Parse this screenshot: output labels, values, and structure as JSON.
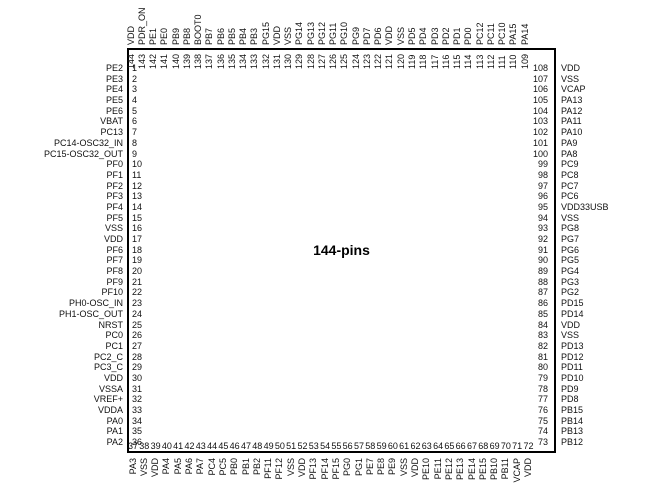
{
  "chip": {
    "title": "144-pins"
  },
  "colors": {
    "ink": "#111111",
    "border": "#000000",
    "background": "#ffffff"
  },
  "pins": {
    "left": [
      {
        "n": "1",
        "l": "PE2"
      },
      {
        "n": "2",
        "l": "PE3"
      },
      {
        "n": "3",
        "l": "PE4"
      },
      {
        "n": "4",
        "l": "PE5"
      },
      {
        "n": "5",
        "l": "PE6"
      },
      {
        "n": "6",
        "l": "VBAT"
      },
      {
        "n": "7",
        "l": "PC13"
      },
      {
        "n": "8",
        "l": "PC14-OSC32_IN"
      },
      {
        "n": "9",
        "l": "PC15-OSC32_OUT"
      },
      {
        "n": "10",
        "l": "PF0"
      },
      {
        "n": "11",
        "l": "PF1"
      },
      {
        "n": "12",
        "l": "PF2"
      },
      {
        "n": "13",
        "l": "PF3"
      },
      {
        "n": "14",
        "l": "PF4"
      },
      {
        "n": "15",
        "l": "PF5"
      },
      {
        "n": "16",
        "l": "VSS"
      },
      {
        "n": "17",
        "l": "VDD"
      },
      {
        "n": "18",
        "l": "PF6"
      },
      {
        "n": "19",
        "l": "PF7"
      },
      {
        "n": "20",
        "l": "PF8"
      },
      {
        "n": "21",
        "l": "PF9"
      },
      {
        "n": "22",
        "l": "PF10"
      },
      {
        "n": "23",
        "l": "PH0-OSC_IN"
      },
      {
        "n": "24",
        "l": "PH1-OSC_OUT"
      },
      {
        "n": "25",
        "l": "NRST"
      },
      {
        "n": "26",
        "l": "PC0"
      },
      {
        "n": "27",
        "l": "PC1"
      },
      {
        "n": "28",
        "l": "PC2_C"
      },
      {
        "n": "29",
        "l": "PC3_C"
      },
      {
        "n": "30",
        "l": "VDD"
      },
      {
        "n": "31",
        "l": "VSSA"
      },
      {
        "n": "32",
        "l": "VREF+"
      },
      {
        "n": "33",
        "l": "VDDA"
      },
      {
        "n": "34",
        "l": "PA0"
      },
      {
        "n": "35",
        "l": "PA1"
      },
      {
        "n": "36",
        "l": "PA2"
      }
    ],
    "bottom": [
      {
        "n": "37",
        "l": "PA3"
      },
      {
        "n": "38",
        "l": "VSS"
      },
      {
        "n": "39",
        "l": "VDD"
      },
      {
        "n": "40",
        "l": "PA4"
      },
      {
        "n": "41",
        "l": "PA5"
      },
      {
        "n": "42",
        "l": "PA6"
      },
      {
        "n": "43",
        "l": "PA7"
      },
      {
        "n": "44",
        "l": "PC4"
      },
      {
        "n": "45",
        "l": "PC5"
      },
      {
        "n": "46",
        "l": "PB0"
      },
      {
        "n": "47",
        "l": "PB1"
      },
      {
        "n": "48",
        "l": "PB2"
      },
      {
        "n": "49",
        "l": "PF11"
      },
      {
        "n": "50",
        "l": "PF12"
      },
      {
        "n": "51",
        "l": "VSS"
      },
      {
        "n": "52",
        "l": "VDD"
      },
      {
        "n": "53",
        "l": "PF13"
      },
      {
        "n": "54",
        "l": "PF14"
      },
      {
        "n": "55",
        "l": "PF15"
      },
      {
        "n": "56",
        "l": "PG0"
      },
      {
        "n": "57",
        "l": "PG1"
      },
      {
        "n": "58",
        "l": "PE7"
      },
      {
        "n": "59",
        "l": "PE8"
      },
      {
        "n": "60",
        "l": "PE9"
      },
      {
        "n": "61",
        "l": "VSS"
      },
      {
        "n": "62",
        "l": "VDD"
      },
      {
        "n": "63",
        "l": "PE10"
      },
      {
        "n": "64",
        "l": "PE11"
      },
      {
        "n": "65",
        "l": "PE12"
      },
      {
        "n": "66",
        "l": "PE13"
      },
      {
        "n": "67",
        "l": "PE14"
      },
      {
        "n": "68",
        "l": "PE15"
      },
      {
        "n": "69",
        "l": "PB10"
      },
      {
        "n": "70",
        "l": "PB11"
      },
      {
        "n": "71",
        "l": "VCAP"
      },
      {
        "n": "72",
        "l": "VDD"
      }
    ],
    "right": [
      {
        "n": "108",
        "l": "VDD"
      },
      {
        "n": "107",
        "l": "VSS"
      },
      {
        "n": "106",
        "l": "VCAP"
      },
      {
        "n": "105",
        "l": "PA13"
      },
      {
        "n": "104",
        "l": "PA12"
      },
      {
        "n": "103",
        "l": "PA11"
      },
      {
        "n": "102",
        "l": "PA10"
      },
      {
        "n": "101",
        "l": "PA9"
      },
      {
        "n": "100",
        "l": "PA8"
      },
      {
        "n": "99",
        "l": "PC9"
      },
      {
        "n": "98",
        "l": "PC8"
      },
      {
        "n": "97",
        "l": "PC7"
      },
      {
        "n": "96",
        "l": "PC6"
      },
      {
        "n": "95",
        "l": "VDD33USB"
      },
      {
        "n": "94",
        "l": "VSS"
      },
      {
        "n": "93",
        "l": "PG8"
      },
      {
        "n": "92",
        "l": "PG7"
      },
      {
        "n": "91",
        "l": "PG6"
      },
      {
        "n": "90",
        "l": "PG5"
      },
      {
        "n": "89",
        "l": "PG4"
      },
      {
        "n": "88",
        "l": "PG3"
      },
      {
        "n": "87",
        "l": "PG2"
      },
      {
        "n": "86",
        "l": "PD15"
      },
      {
        "n": "85",
        "l": "PD14"
      },
      {
        "n": "84",
        "l": "VDD"
      },
      {
        "n": "83",
        "l": "VSS"
      },
      {
        "n": "82",
        "l": "PD13"
      },
      {
        "n": "81",
        "l": "PD12"
      },
      {
        "n": "80",
        "l": "PD11"
      },
      {
        "n": "79",
        "l": "PD10"
      },
      {
        "n": "78",
        "l": "PD9"
      },
      {
        "n": "77",
        "l": "PD8"
      },
      {
        "n": "76",
        "l": "PB15"
      },
      {
        "n": "75",
        "l": "PB14"
      },
      {
        "n": "74",
        "l": "PB13"
      },
      {
        "n": "73",
        "l": "PB12"
      }
    ],
    "top": [
      {
        "n": "144",
        "l": "VDD"
      },
      {
        "n": "143",
        "l": "PDR_ON"
      },
      {
        "n": "142",
        "l": "PE1"
      },
      {
        "n": "141",
        "l": "PE0"
      },
      {
        "n": "140",
        "l": "PB9"
      },
      {
        "n": "139",
        "l": "PB8"
      },
      {
        "n": "138",
        "l": "BOOT0"
      },
      {
        "n": "137",
        "l": "PB7"
      },
      {
        "n": "136",
        "l": "PB6"
      },
      {
        "n": "135",
        "l": "PB5"
      },
      {
        "n": "134",
        "l": "PB4"
      },
      {
        "n": "133",
        "l": "PB3"
      },
      {
        "n": "132",
        "l": "PG15"
      },
      {
        "n": "131",
        "l": "VDD"
      },
      {
        "n": "130",
        "l": "VSS"
      },
      {
        "n": "129",
        "l": "PG14"
      },
      {
        "n": "128",
        "l": "PG13"
      },
      {
        "n": "127",
        "l": "PG12"
      },
      {
        "n": "126",
        "l": "PG11"
      },
      {
        "n": "125",
        "l": "PG10"
      },
      {
        "n": "124",
        "l": "PG9"
      },
      {
        "n": "123",
        "l": "PD7"
      },
      {
        "n": "122",
        "l": "PD6"
      },
      {
        "n": "121",
        "l": "VDD"
      },
      {
        "n": "120",
        "l": "VSS"
      },
      {
        "n": "119",
        "l": "PD5"
      },
      {
        "n": "118",
        "l": "PD4"
      },
      {
        "n": "117",
        "l": "PD3"
      },
      {
        "n": "116",
        "l": "PD2"
      },
      {
        "n": "115",
        "l": "PD1"
      },
      {
        "n": "114",
        "l": "PD0"
      },
      {
        "n": "113",
        "l": "PC12"
      },
      {
        "n": "112",
        "l": "PC11"
      },
      {
        "n": "111",
        "l": "PC10"
      },
      {
        "n": "110",
        "l": "PA15"
      },
      {
        "n": "109",
        "l": "PA14"
      }
    ]
  }
}
